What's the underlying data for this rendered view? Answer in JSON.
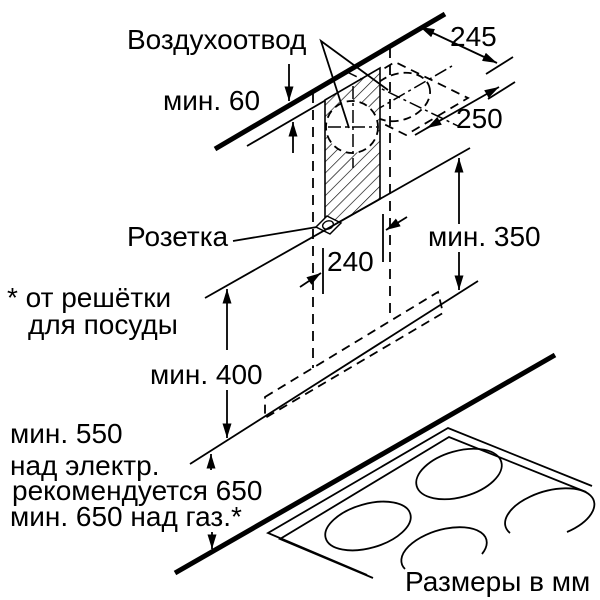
{
  "diagram": {
    "title_note": "Размеры в мм",
    "labels": {
      "air_outlet": "Воздухоотвод",
      "socket": "Розетка",
      "footnote_line1": "* от решётки",
      "footnote_line2": "для посуды",
      "units_note": "Размеры в мм"
    },
    "dimensions": {
      "ceiling_gap": "мин. 60",
      "depth_to_wall": "245",
      "vent_depth": "250",
      "duct_width": "240",
      "flue_min_height": "мин. 350",
      "chimney_min_height": "мин. 400",
      "clearance_line1": "мин. 550",
      "clearance_line2": "над электр.",
      "clearance_line3": "рекомендуется 650",
      "clearance_line4": "мин. 650 над газ.*"
    },
    "colors": {
      "line": "#000000",
      "background": "#ffffff"
    }
  }
}
